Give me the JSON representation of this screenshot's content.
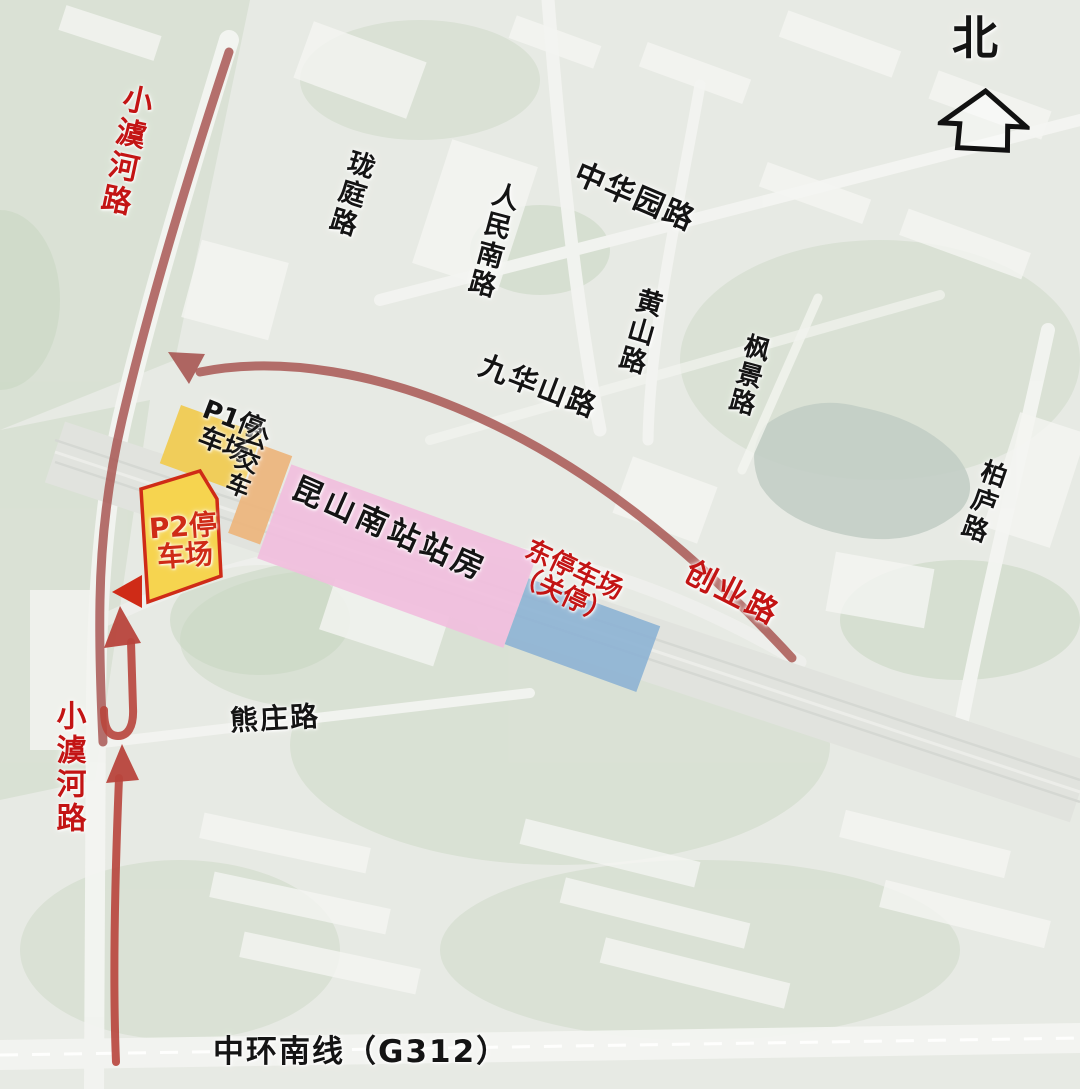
{
  "compass": {
    "label": "北"
  },
  "roads": {
    "xiaoyuhe_top": "小澞河路",
    "longting": "珑庭路",
    "renmin_south": "人民南路",
    "zhonghuayuan": "中华园路",
    "huangshan": "黄山路",
    "jiuhuashan": "九华山路",
    "fengjing": "枫景路",
    "bailu": "柏庐路",
    "chuangye": "创业路",
    "xiongzhuang": "熊庄路",
    "xiaoyuhe_bottom": "小澞河路",
    "zhonghuan_nanxian": "中环南线（G312）"
  },
  "zones": {
    "p1_lot": {
      "line1": "P1停",
      "line2": "车场",
      "fill": "#f0cb52",
      "text_color": "#141414"
    },
    "bus": {
      "label": "公交车",
      "fill": "#ecb67e",
      "text_color": "#141414"
    },
    "station": {
      "label": "昆山南站站房",
      "fill": "#f1bedd",
      "text_color": "#141414"
    },
    "east_lot": {
      "line1": "东停车场",
      "line2": "（关停）",
      "fill": "#8db2d4",
      "text_color": "#c62222"
    },
    "p2_lot": {
      "line1": "P2停",
      "line2": "车场",
      "fill": "#f6d44f",
      "border": "#cf2b17",
      "text_color": "#cf2b17"
    }
  },
  "colors": {
    "route_primary": "#a6524e",
    "route_bright": "#b8453c",
    "road_label_red": "#c31414",
    "road_label_black": "#141414"
  }
}
